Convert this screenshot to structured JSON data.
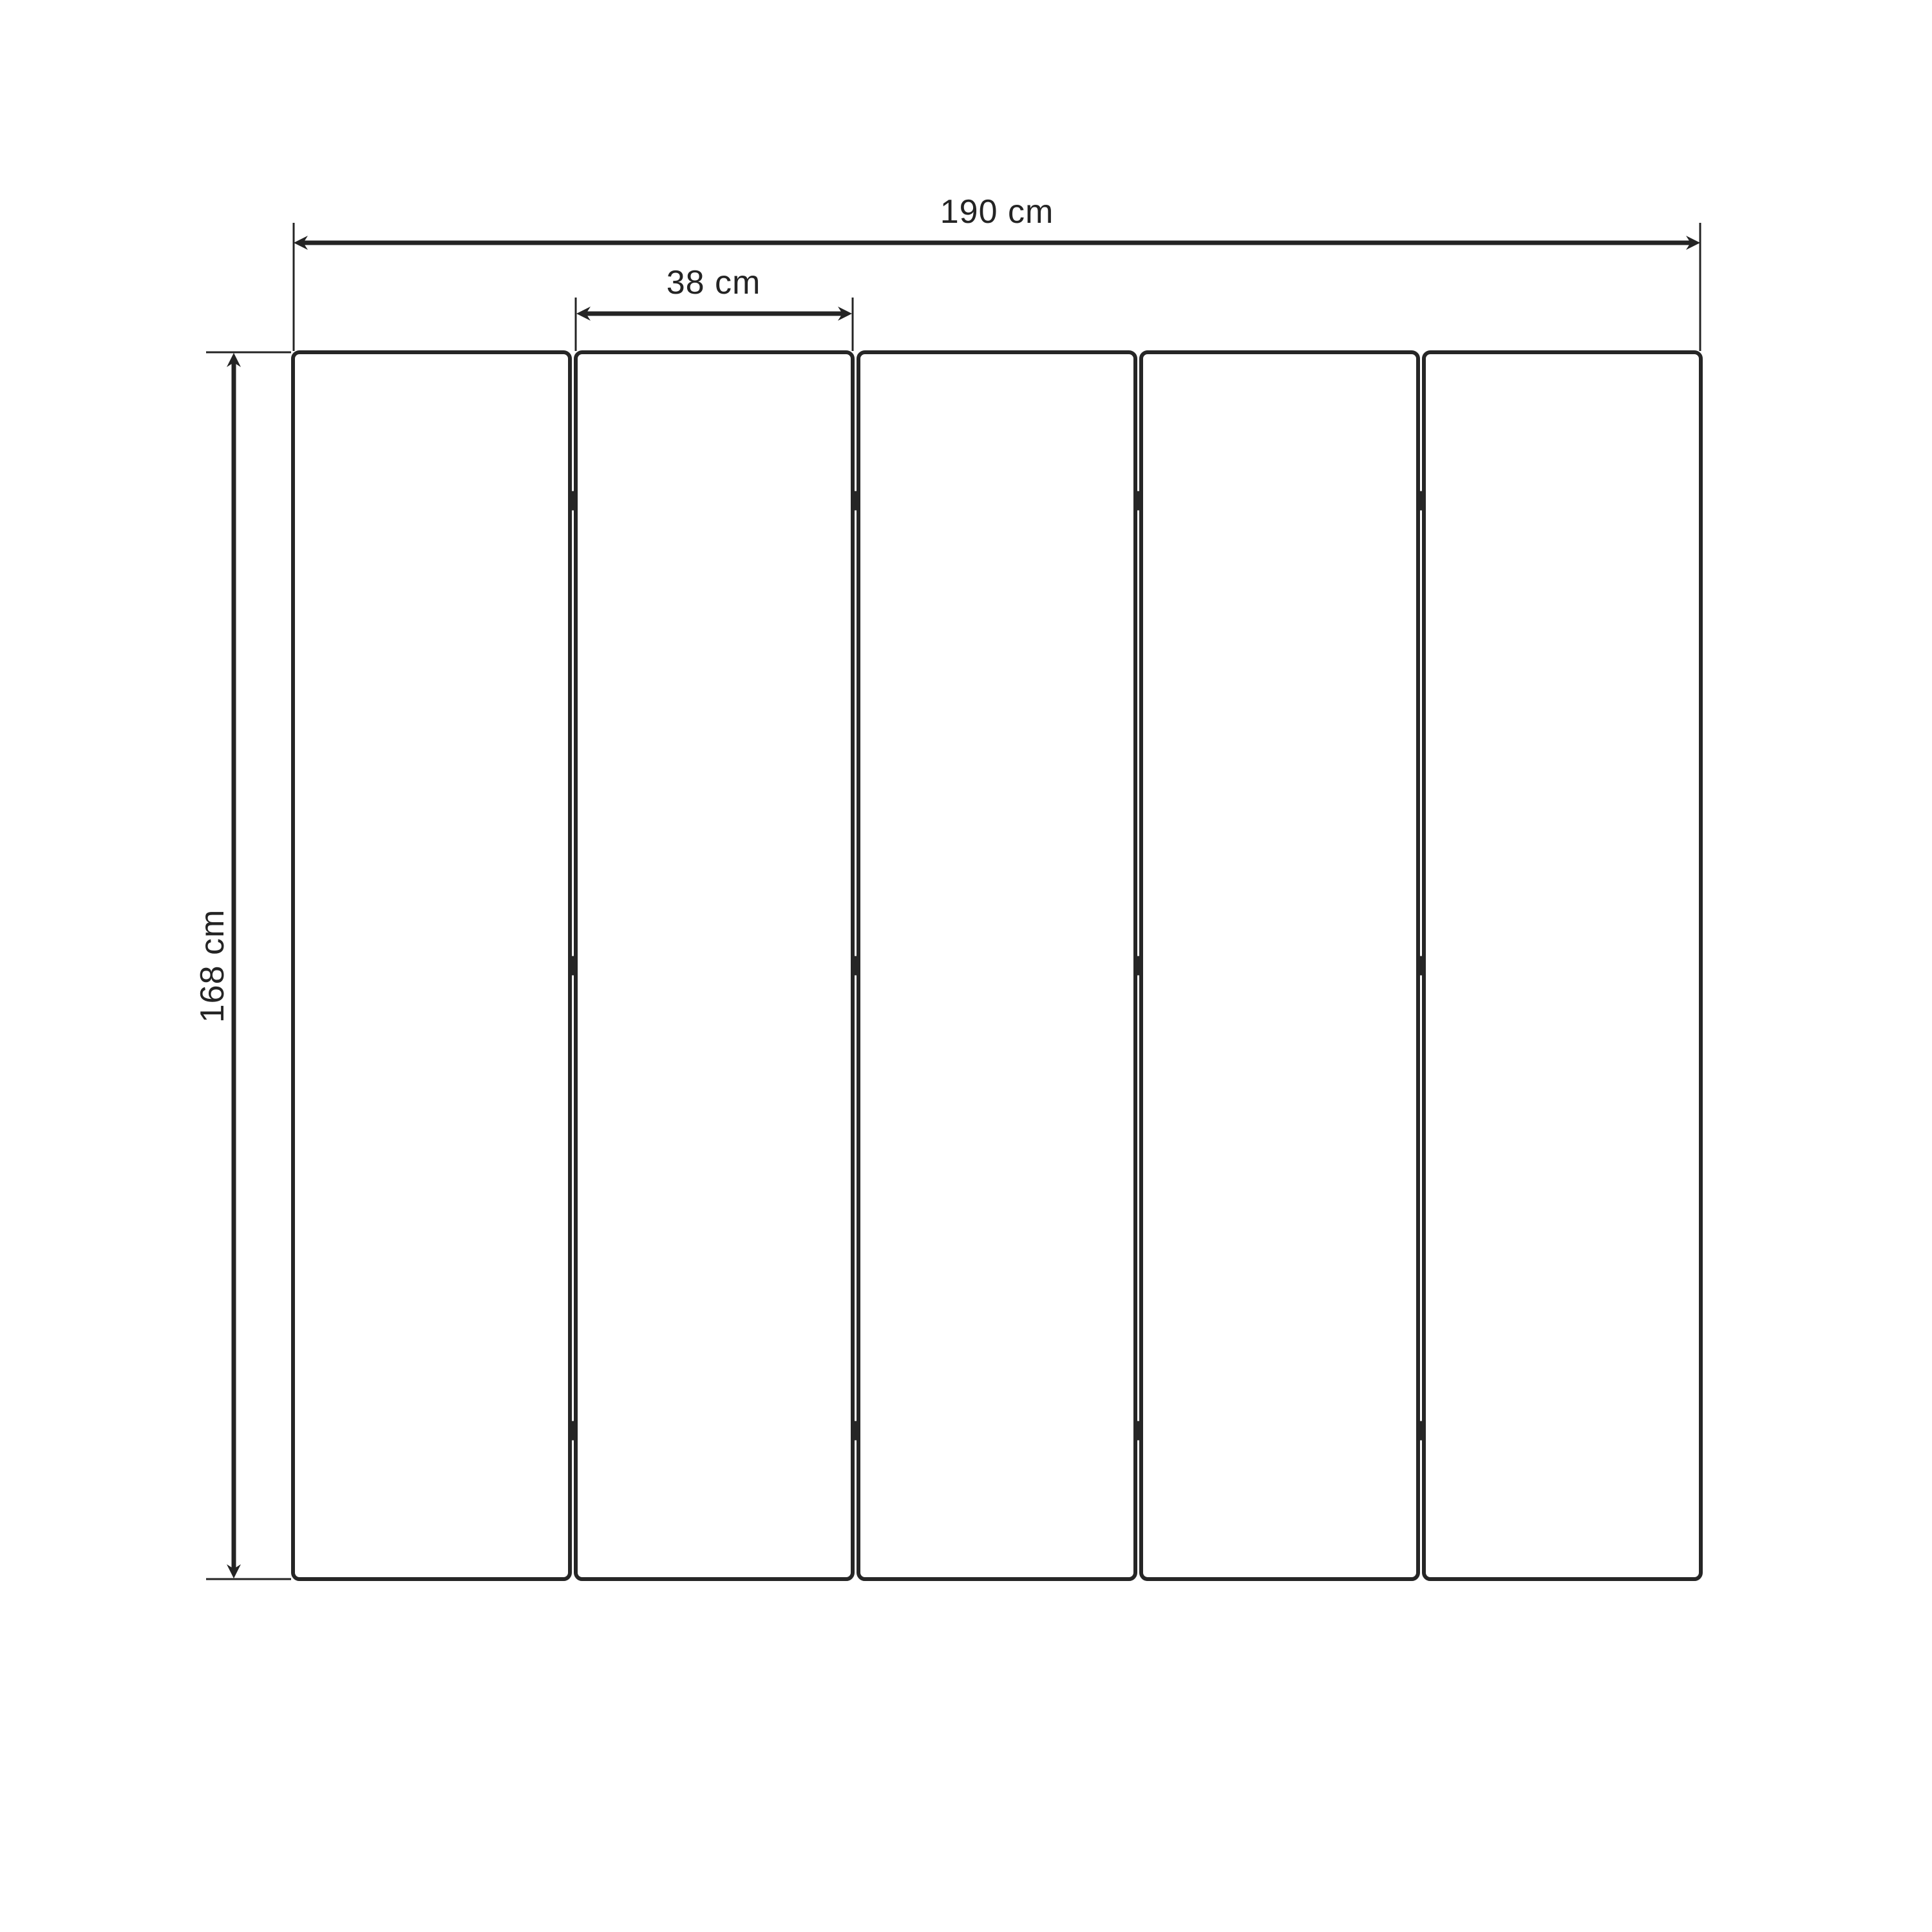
{
  "diagram": {
    "kind": "technical-dimension-drawing",
    "subject": "five-panel folding room divider, front elevation",
    "background_color": "#ffffff",
    "line_color": "#242424",
    "panel_fill": "#ffffff",
    "hinge_color": "#262626",
    "panels": {
      "count": 5,
      "gap_count": 4
    },
    "hinges": {
      "rows_per_gap": 3,
      "total": 12
    },
    "dimensions": {
      "total_width": {
        "label": "190 cm"
      },
      "panel_width": {
        "label": "38 cm"
      },
      "height": {
        "label": "168 cm"
      }
    }
  }
}
